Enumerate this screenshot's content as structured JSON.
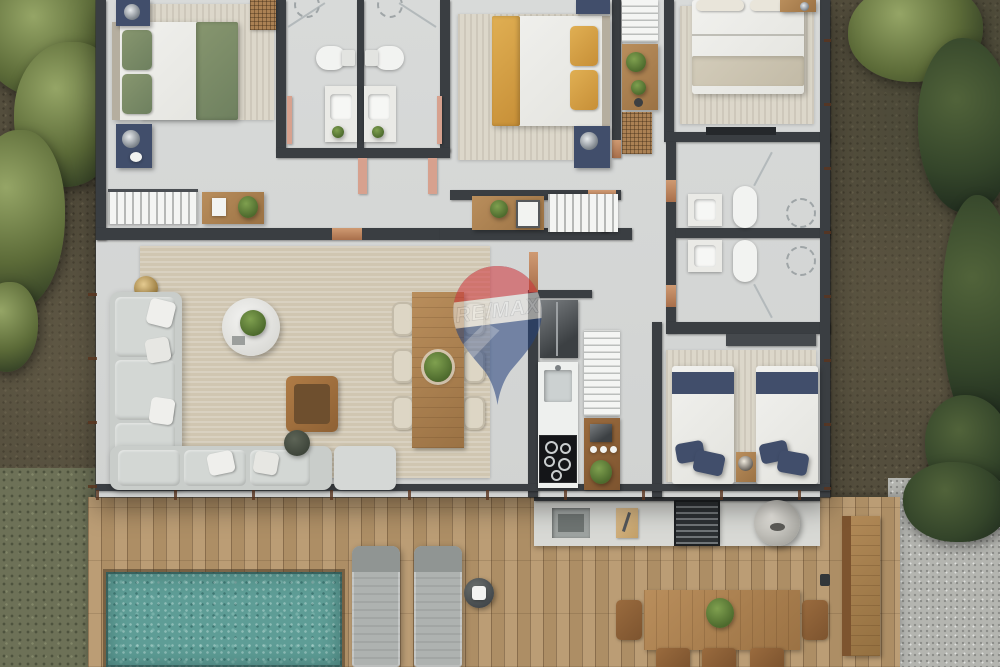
{
  "scene_type": "top-down 3d rendered residential floor plan",
  "watermark": {
    "text": "RE/MAX",
    "balloon_red": "#cf3339",
    "balloon_blue": "#23407c",
    "band_white": "#e9e7e3"
  },
  "colors": {
    "ground_soil": "#544e3d",
    "foliage_light": "#95a566",
    "foliage_dark": "#34452a",
    "lawn_moss": "#6d7157",
    "gravel": "#b4b5b0",
    "deck_wood": "#b4966e",
    "pool_water": "#5e9d96",
    "interior_floor": "#d5d7d6",
    "walls": "#3a3e42",
    "copper_frames": "#b5795f",
    "sofa_gray": "#c9cdca",
    "rug_beige": "#d0c6b1",
    "bed_green": "#87966f",
    "bed_yellow": "#e0af53",
    "bed_navy": "#414e6b",
    "wood_furniture": "#b98e5c",
    "cooktop_black": "#141518"
  },
  "rooms": [
    {
      "name": "bedroom-1",
      "furniture": [
        "double-bed-green",
        "nightstand-top",
        "nightstand-bottom",
        "area-rug",
        "clothes-rack",
        "desk-with-plant",
        "wicker-basket"
      ]
    },
    {
      "name": "bathroom-1",
      "furniture": [
        "shower",
        "toilet",
        "vanity-sink",
        "door"
      ]
    },
    {
      "name": "bathroom-2",
      "furniture": [
        "shower",
        "toilet",
        "vanity-sink",
        "door"
      ]
    },
    {
      "name": "bedroom-2",
      "furniture": [
        "double-bed-yellow",
        "nightstand-top",
        "nightstand-bottom",
        "area-rug"
      ]
    },
    {
      "name": "hallway",
      "furniture": [
        "wood-sideboard",
        "white-bench",
        "console-table",
        "storage-baskets",
        "wall-shelf"
      ]
    },
    {
      "name": "master-bedroom",
      "furniture": [
        "double-bed-beige",
        "area-rug",
        "dresser",
        "tv-console"
      ]
    },
    {
      "name": "master-bathroom",
      "furniture": [
        "vanity-sink",
        "toilet",
        "shower"
      ]
    },
    {
      "name": "bathroom-3",
      "furniture": [
        "vanity-sink",
        "toilet",
        "shower"
      ]
    },
    {
      "name": "living-room",
      "furniture": [
        "l-shaped-sofa",
        "ottoman",
        "round-coffee-table",
        "wood-armchair",
        "side-table",
        "floor-lamp",
        "area-rug",
        "throw-pillows"
      ]
    },
    {
      "name": "dining-room",
      "furniture": [
        "wood-dining-table",
        "dining-chairs-6",
        "plant-centerpiece"
      ]
    },
    {
      "name": "kitchen",
      "furniture": [
        "refrigerator",
        "sink-counter",
        "cooktop",
        "pantry-shelves",
        "coffee-bar-with-plant"
      ]
    },
    {
      "name": "twin-bedroom",
      "furniture": [
        "twin-bed-left",
        "twin-bed-right",
        "shared-nightstand",
        "wardrobe",
        "area-rug"
      ]
    },
    {
      "name": "pool-deck",
      "furniture": [
        "swimming-pool",
        "sun-lounger-1",
        "sun-lounger-2",
        "side-table",
        "deck-light"
      ]
    },
    {
      "name": "outdoor-kitchen",
      "furniture": [
        "counter",
        "sink",
        "cutting-board",
        "grill",
        "sphere-oven"
      ]
    },
    {
      "name": "outdoor-dining",
      "furniture": [
        "wood-table",
        "plant-centerpiece",
        "chairs",
        "lounge-bench"
      ]
    },
    {
      "name": "garden",
      "furniture": [
        "tropical-plants",
        "shrubs",
        "gravel-patch",
        "lawn-patch"
      ]
    }
  ]
}
